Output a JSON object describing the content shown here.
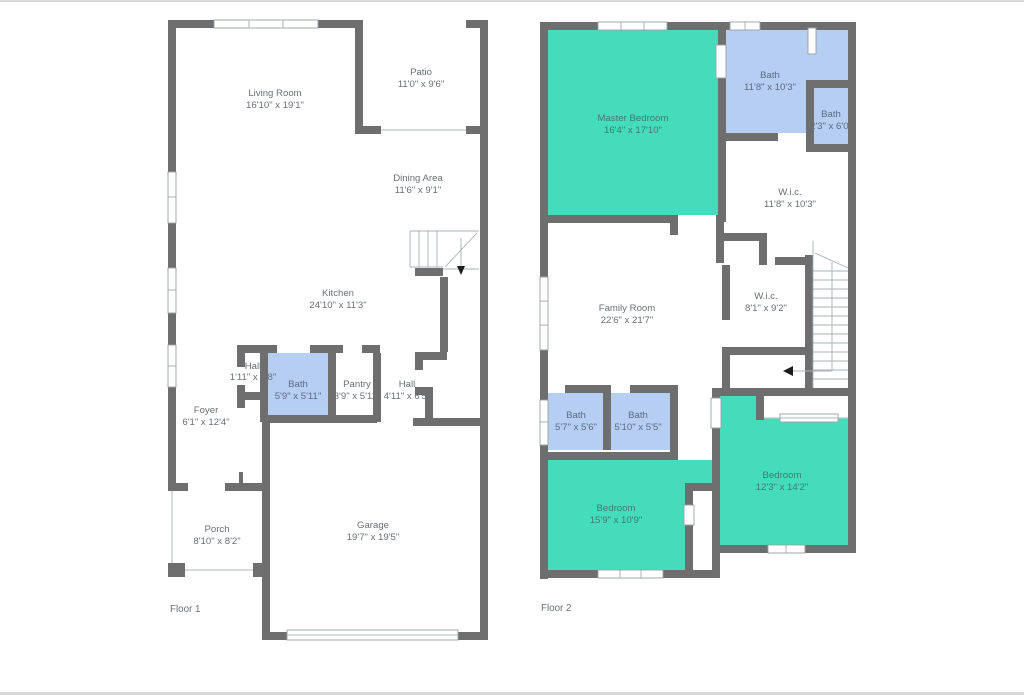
{
  "page": {
    "type": "floor-plan-drawing"
  },
  "floor1": {
    "label": "Floor 1",
    "rooms": {
      "living": {
        "name": "Living Room",
        "dims": "16'10\" x 19'1\""
      },
      "patio": {
        "name": "Patio",
        "dims": "11'0\" x 9'6\""
      },
      "dining": {
        "name": "Dining Area",
        "dims": "11'6\" x 9'1\""
      },
      "kitchen": {
        "name": "Kitchen",
        "dims": "24'10\" x 11'3\""
      },
      "hall_small": {
        "name": "Hall",
        "dims": "1'11\" x 3'8\""
      },
      "bath": {
        "name": "Bath",
        "dims": "5'9\" x 5'11\""
      },
      "pantry": {
        "name": "Pantry",
        "dims": "3'9\" x 5'11\""
      },
      "hall": {
        "name": "Hall",
        "dims": "4'11\" x 6'5\""
      },
      "foyer": {
        "name": "Foyer",
        "dims": "6'1\" x 12'4\""
      },
      "porch": {
        "name": "Porch",
        "dims": "8'10\" x 8'2\""
      },
      "garage": {
        "name": "Garage",
        "dims": "19'7\" x 19'5\""
      }
    }
  },
  "floor2": {
    "label": "Floor 2",
    "rooms": {
      "master": {
        "name": "Master Bedroom",
        "dims": "16'4\" x 17'10\""
      },
      "bath_main": {
        "name": "Bath",
        "dims": "11'8\" x 10'3\""
      },
      "bath_small": {
        "name": "Bath",
        "dims": "2'3\" x 6'0\""
      },
      "wic_large": {
        "name": "W.i.c.",
        "dims": "11'8\" x 10'3\""
      },
      "family": {
        "name": "Family Room",
        "dims": "22'6\" x 21'7\""
      },
      "wic_small": {
        "name": "W.i.c.",
        "dims": "8'1\" x 9'2\""
      },
      "bath_a": {
        "name": "Bath",
        "dims": "5'7\" x 5'6\""
      },
      "bath_b": {
        "name": "Bath",
        "dims": "5'10\" x 5'5\""
      },
      "bedroom_left": {
        "name": "Bedroom",
        "dims": "15'9\" x 10'9\""
      },
      "bedroom_right": {
        "name": "Bedroom",
        "dims": "12'3\" x 14'2\""
      }
    }
  },
  "colors": {
    "wall": "#6e6e6e",
    "teal": "#45dcbb",
    "blue": "#b5cef1",
    "text": "#6a7076",
    "text_teal": "#3f7a70",
    "text_blue": "#5d6b85"
  }
}
